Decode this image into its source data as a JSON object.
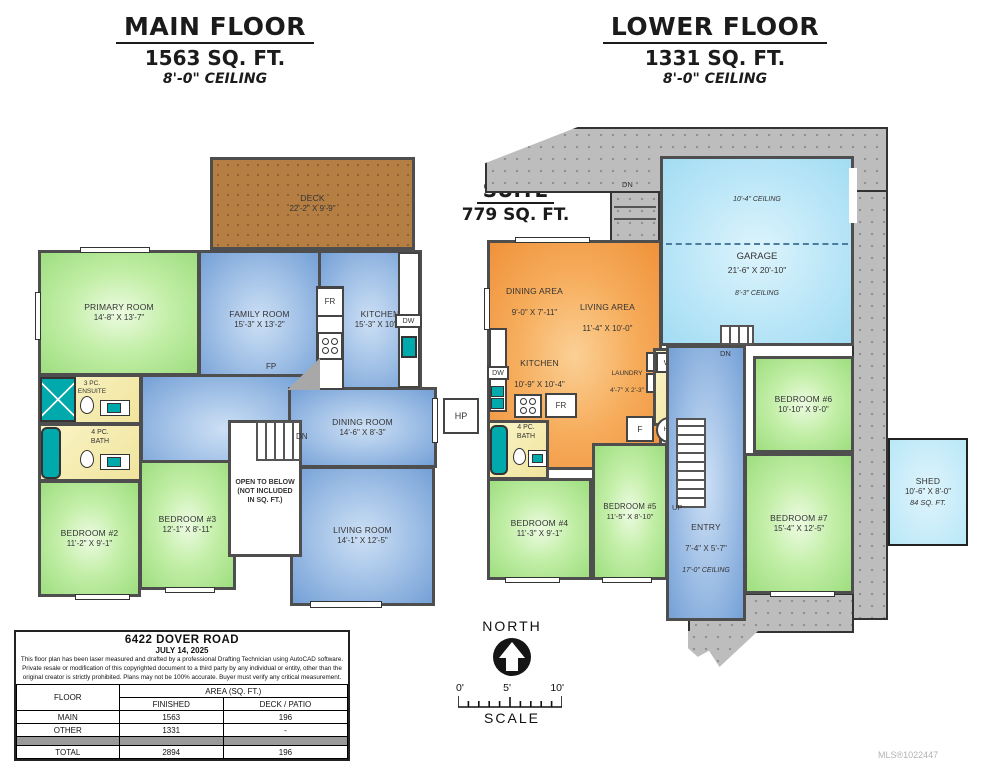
{
  "main_floor": {
    "title": "MAIN FLOOR",
    "area": "1563 SQ. FT.",
    "ceiling": "8'-0\" CEILING",
    "rooms": {
      "deck": {
        "name": "DECK",
        "dims": "22'-2\" X 9'-9\""
      },
      "primary": {
        "name": "PRIMARY ROOM",
        "dims": "14'-8\" X 13'-7\""
      },
      "family": {
        "name": "FAMILY ROOM",
        "dims": "15'-3\" X 13'-2\""
      },
      "kitchen": {
        "name": "KITCHEN",
        "dims": "15'-3\" X 10'-1\""
      },
      "dining": {
        "name": "DINING ROOM",
        "dims": "14'-6\" X 8'-3\""
      },
      "living": {
        "name": "LIVING ROOM",
        "dims": "14'-1\" X 12'-5\""
      },
      "ensuite": {
        "name": "3 PC.\nENSUITE"
      },
      "bath": {
        "name": "4 PC.\nBATH"
      },
      "bedroom2": {
        "name": "BEDROOM #2",
        "dims": "11'-2\" X 9'-1\""
      },
      "bedroom3": {
        "name": "BEDROOM #3",
        "dims": "12'-1\" X 8'-11\""
      },
      "open_below": "OPEN TO BELOW\n(NOT INCLUDED\nIN SQ. FT.)"
    }
  },
  "lower_floor": {
    "title": "LOWER FLOOR",
    "area": "1331 SQ. FT.",
    "ceiling": "8'-0\" CEILING",
    "suite": {
      "title": "SUITE",
      "area": "779 SQ. FT."
    },
    "rooms": {
      "garage": {
        "name": "GARAGE",
        "dims": "21'-6\" X 20'-10\"",
        "ceiling_high": "10'-4\" CEILING",
        "ceiling_low": "8'-3\" CEILING"
      },
      "dining_area": {
        "name": "DINING AREA",
        "dims": "9'-0\" X 7'-11\""
      },
      "living_area": {
        "name": "LIVING AREA",
        "dims": "11'-4\" X 10'-0\""
      },
      "kitchen": {
        "name": "KITCHEN",
        "dims": "10'-9\" X 10'-4\""
      },
      "laundry": {
        "name": "LAUNDRY",
        "dims": "4'-7\" X 2'-3\""
      },
      "bath": {
        "name": "4 PC.\nBATH"
      },
      "laundry2": {
        "name": "2 PC. /\nLAUNDRY"
      },
      "bedroom4": {
        "name": "BEDROOM #4",
        "dims": "11'-3\" X 9'-1\""
      },
      "bedroom5": {
        "name": "BEDROOM #5",
        "dims": "11'-5\" X 8'-10\""
      },
      "bedroom6": {
        "name": "BEDROOM #6",
        "dims": "10'-10\" X 9'-0\""
      },
      "bedroom7": {
        "name": "BEDROOM #7",
        "dims": "15'-4\" X 12'-5\""
      },
      "entry": {
        "name": "ENTRY",
        "dims": "7'-4\" X 5'-7\"",
        "ceiling": "17'-0\" CEILING"
      },
      "shed": {
        "name": "SHED",
        "dims": "10'-6\" X 8'-0\"",
        "area": "84 SQ. FT."
      }
    }
  },
  "tags": {
    "fr": "FR",
    "dw": "DW",
    "fp": "FP",
    "dn": "DN",
    "up": "UP",
    "hp": "HP",
    "w": "W",
    "d": "D",
    "wd": "W/D",
    "f": "F",
    "hw": "HW"
  },
  "info_box": {
    "address": "6422 DOVER ROAD",
    "date": "JULY 14, 2025",
    "disclaimer": "This floor plan has been laser measured and drafted by a professional Drafting Technician using AutoCAD software. Private resale or modification of this copyrighted document to a third party by any individual or entity, other than the original creator is strictly prohibited. Plans may not be 100% accurate.  Buyer must verify any critical measurement.",
    "table": {
      "col_floor": "FLOOR",
      "col_area": "AREA (SQ. FT.)",
      "col_finished": "FINISHED",
      "col_deck": "DECK / PATIO",
      "rows": [
        {
          "floor": "MAIN",
          "finished": "1563",
          "deck": "196"
        },
        {
          "floor": "OTHER",
          "finished": "1331",
          "deck": "-"
        }
      ],
      "total": {
        "floor": "TOTAL",
        "finished": "2894",
        "deck": "196"
      }
    }
  },
  "compass": {
    "north": "NORTH",
    "scale": "SCALE",
    "tick0": "0'",
    "tick5": "5'",
    "tick10": "10'"
  },
  "watermark": "MLS®1022447",
  "colors": {
    "wall": "#4e4e4e",
    "bedroom_green": "#9ede7f",
    "living_blue": "#74a0d6",
    "suite_orange": "#f0913a",
    "garage_cyan": "#a2dcf3",
    "deck_brown": "#b57f44",
    "bath_yellow": "#f0e49c",
    "fixture_teal": "#00a9ab",
    "concrete_gray": "#bdbdbd"
  }
}
